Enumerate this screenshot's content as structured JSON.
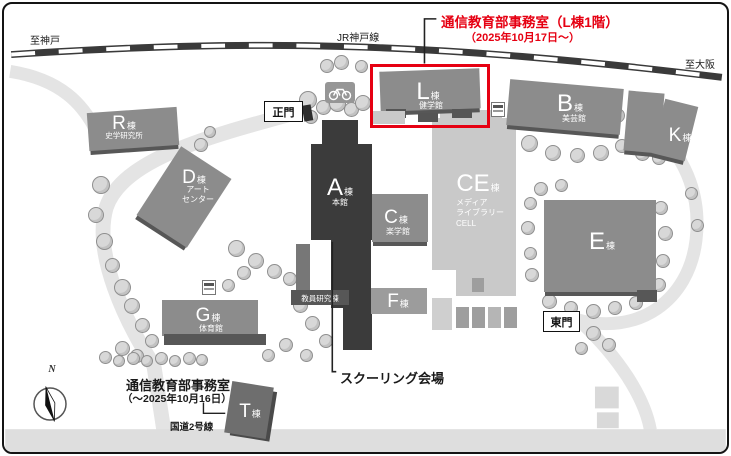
{
  "highlight": {
    "title_line1": "通信教育部事務室（L棟1階）",
    "title_line2": "（2025年10月17日～）",
    "color": "#e60012"
  },
  "former_office": {
    "line1": "通信教育部事務室",
    "line2": "（～2025年10月16日）"
  },
  "schooling_venue_label": "スクーリング会場",
  "railway": {
    "name": "JR神戸線",
    "direction_left": "至神戸",
    "direction_right": "至大阪"
  },
  "road": {
    "name": "国道2号線"
  },
  "gates": {
    "main": "正門",
    "east": "東門"
  },
  "compass": {
    "north": "N"
  },
  "buildings": {
    "A": {
      "letter": "A",
      "suffix": "棟",
      "note": "本館"
    },
    "B": {
      "letter": "B",
      "suffix": "棟",
      "note": "美芸館"
    },
    "C": {
      "letter": "C",
      "suffix": "棟",
      "note": "楽学館"
    },
    "CE": {
      "letter": "CE",
      "suffix": "棟",
      "note_lines": [
        "メディア",
        "ライブラリー",
        "CELL"
      ]
    },
    "D": {
      "letter": "D",
      "suffix": "棟",
      "note_lines": [
        "アート",
        "センター"
      ]
    },
    "E": {
      "letter": "E",
      "suffix": "棟"
    },
    "F": {
      "letter": "F",
      "suffix": "棟"
    },
    "G": {
      "letter": "G",
      "suffix": "棟",
      "note": "体育館"
    },
    "K": {
      "letter": "K",
      "suffix": "棟"
    },
    "L": {
      "letter": "L",
      "suffix": "棟",
      "note": "健学館"
    },
    "R": {
      "letter": "R",
      "suffix": "棟",
      "note": "史学研究所"
    },
    "T": {
      "letter": "T",
      "suffix": "棟"
    },
    "faculty_research": {
      "label": "教員研究棟"
    }
  },
  "icons": {
    "bicycle_parking": "bicycle",
    "facility_sign": "sign",
    "compass_needle": "needle"
  }
}
